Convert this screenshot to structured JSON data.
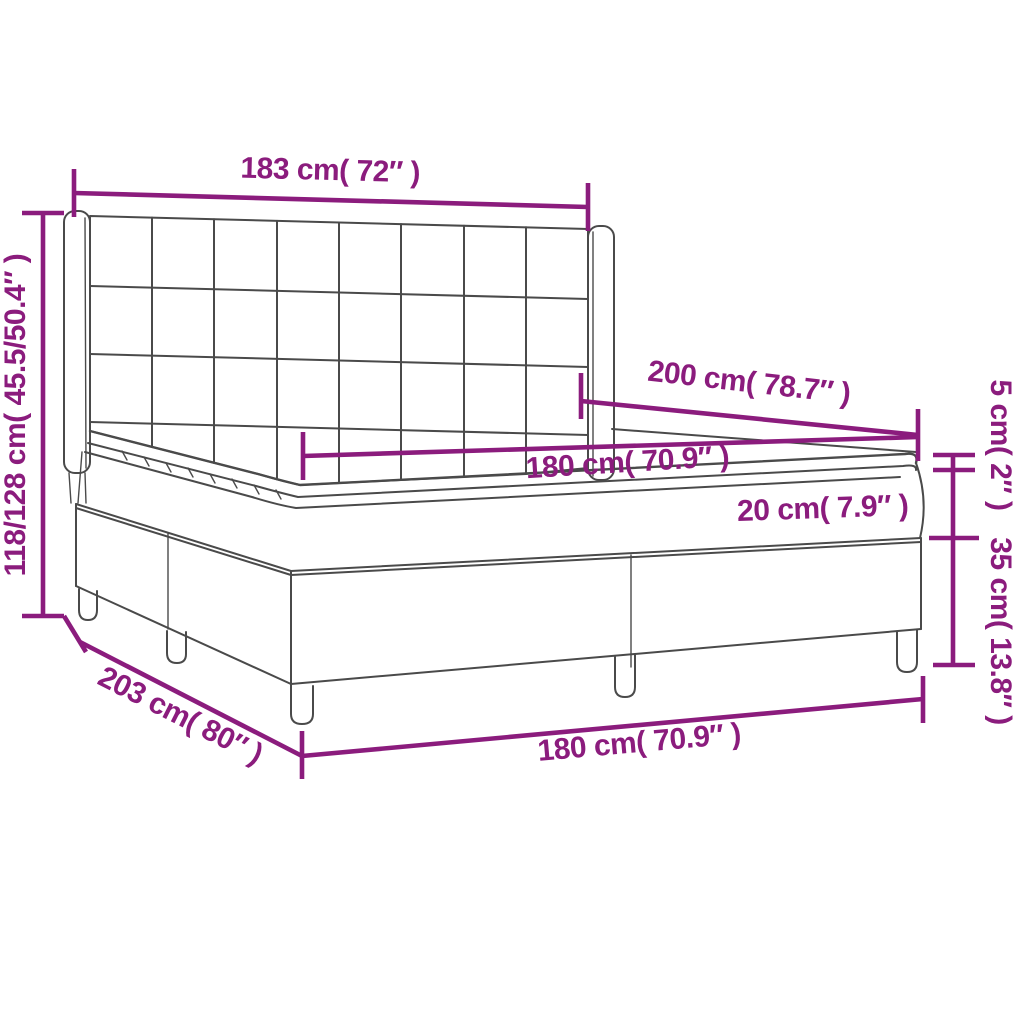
{
  "diagram": {
    "title": "box spring bed with tufted wing headboard - dimension diagram",
    "colors": {
      "accent": "#8B1C7D",
      "outline": "#4A4A4A",
      "background": "#FFFFFF"
    },
    "labels": {
      "headboard_width": "183 cm( 72″ )",
      "overall_height": "118/128 cm( 45.5/50.4″ )",
      "bed_length": "200 cm( 78.7″ )",
      "sleeping_width": "180 cm( 70.9″ )",
      "mattress_thickness": "20 cm( 7.9″ )",
      "topper_thickness": "5 cm( 2″ )",
      "base_height": "35 cm( 13.8″ )",
      "base_length": "203 cm( 80″ )",
      "base_width": "180 cm( 70.9″ )"
    }
  }
}
